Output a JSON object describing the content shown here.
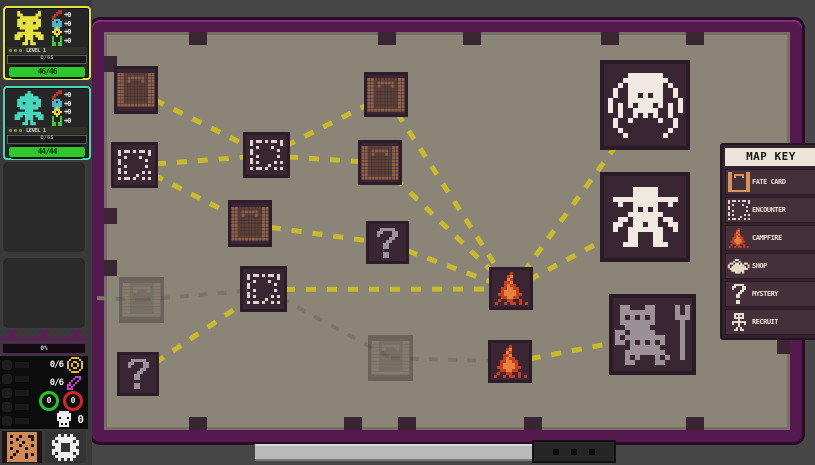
{
  "party": {
    "members": [
      {
        "portrait": "yellow-adventurer",
        "accent": "#e6e23e",
        "level_label": "LEVEL 1",
        "xp_label": "0/65",
        "hp_label": "46/46",
        "stats": [
          {
            "icon": "attack-icon",
            "value": "+0"
          },
          {
            "icon": "armor-icon",
            "value": "+0"
          },
          {
            "icon": "focus-icon",
            "value": "+0"
          },
          {
            "icon": "speed-icon",
            "value": "+0"
          }
        ]
      },
      {
        "portrait": "teal-adventurer",
        "accent": "#46d8be",
        "level_label": "LEVEL 1",
        "xp_label": "0/65",
        "hp_label": "44/44",
        "stats": [
          {
            "icon": "attack-icon",
            "value": "+0"
          },
          {
            "icon": "armor-icon",
            "value": "+0"
          },
          {
            "icon": "focus-icon",
            "value": "+0"
          },
          {
            "icon": "speed-icon",
            "value": "+0"
          }
        ]
      }
    ],
    "empty_slots": 2
  },
  "resources": {
    "progress_label": "0%",
    "counters": [
      {
        "icon": "coin-icon",
        "value": "0/6"
      },
      {
        "icon": "gem-icon",
        "value": "0/6"
      }
    ],
    "orbs": [
      {
        "icon": "green-orb",
        "value": "0"
      },
      {
        "icon": "red-orb",
        "value": "0"
      }
    ],
    "kills": {
      "icon": "skull-icon",
      "value": "0"
    }
  },
  "map_key": {
    "title": "MAP KEY",
    "entries": [
      {
        "icon": "fate-card-icon",
        "label": "FATE CARD"
      },
      {
        "icon": "encounter-icon",
        "label": "ENCOUNTER"
      },
      {
        "icon": "campfire-icon",
        "label": "CAMPFIRE"
      },
      {
        "icon": "shop-icon",
        "label": "SHOP"
      },
      {
        "icon": "mystery-icon",
        "label": "MYSTERY"
      },
      {
        "icon": "recruit-icon",
        "label": "RECRUIT"
      }
    ]
  },
  "map": {
    "nodes": [
      {
        "id": "n1",
        "type": "fate-card",
        "x": 114,
        "y": 66,
        "w": 44,
        "h": 48
      },
      {
        "id": "n2",
        "type": "encounter",
        "x": 111,
        "y": 142,
        "w": 47,
        "h": 46
      },
      {
        "id": "n3",
        "type": "encounter",
        "x": 243,
        "y": 132,
        "w": 47,
        "h": 46
      },
      {
        "id": "n4",
        "type": "fate-card",
        "x": 228,
        "y": 200,
        "w": 44,
        "h": 47
      },
      {
        "id": "n5",
        "type": "fate-card",
        "x": 364,
        "y": 72,
        "w": 44,
        "h": 45
      },
      {
        "id": "n6",
        "type": "fate-card",
        "x": 358,
        "y": 140,
        "w": 44,
        "h": 45
      },
      {
        "id": "n7",
        "type": "mystery",
        "x": 366,
        "y": 221,
        "w": 43,
        "h": 43
      },
      {
        "id": "n8",
        "type": "encounter",
        "x": 240,
        "y": 266,
        "w": 47,
        "h": 46
      },
      {
        "id": "n9",
        "type": "fate-card",
        "state": "visited",
        "x": 119,
        "y": 277,
        "w": 45,
        "h": 46
      },
      {
        "id": "n10",
        "type": "mystery",
        "x": 117,
        "y": 352,
        "w": 42,
        "h": 44
      },
      {
        "id": "n11",
        "type": "fate-card",
        "state": "visited",
        "x": 368,
        "y": 335,
        "w": 45,
        "h": 46
      },
      {
        "id": "n12",
        "type": "campfire",
        "x": 489,
        "y": 267,
        "w": 44,
        "h": 43
      },
      {
        "id": "n13",
        "type": "campfire",
        "x": 488,
        "y": 340,
        "w": 44,
        "h": 43
      },
      {
        "id": "n14",
        "type": "boss-spider",
        "x": 600,
        "y": 60,
        "w": 90,
        "h": 90
      },
      {
        "id": "n15",
        "type": "boss-cowboy",
        "x": 600,
        "y": 172,
        "w": 90,
        "h": 90
      },
      {
        "id": "n16",
        "type": "boss-golem",
        "x": 609,
        "y": 294,
        "w": 87,
        "h": 81
      }
    ],
    "anchor_points": {
      "wall-left": {
        "x": 97,
        "y": 298
      }
    },
    "connections": [
      {
        "a": "n1",
        "b": "n3",
        "style": "path"
      },
      {
        "a": "n2",
        "b": "n3",
        "style": "path"
      },
      {
        "a": "n2",
        "b": "n4",
        "style": "path"
      },
      {
        "a": "n3",
        "b": "n5",
        "style": "path"
      },
      {
        "a": "n3",
        "b": "n6",
        "style": "path"
      },
      {
        "a": "n4",
        "b": "n7",
        "style": "path"
      },
      {
        "a": "n5",
        "b": "n12",
        "style": "path"
      },
      {
        "a": "n6",
        "b": "n12",
        "style": "path"
      },
      {
        "a": "n7",
        "b": "n12",
        "style": "path"
      },
      {
        "a": "n8",
        "b": "n12",
        "style": "path"
      },
      {
        "a": "n10",
        "b": "n8",
        "style": "path"
      },
      {
        "a": "n12",
        "b": "n14",
        "style": "path"
      },
      {
        "a": "n12",
        "b": "n15",
        "style": "path"
      },
      {
        "a": "n13",
        "b": "n16",
        "style": "path"
      },
      {
        "a": "wall-left",
        "b": "n9",
        "style": "traveled"
      },
      {
        "a": "n9",
        "b": "n8",
        "style": "traveled"
      },
      {
        "a": "n8",
        "b": "n11",
        "style": "traveled"
      },
      {
        "a": "n11",
        "b": "n13",
        "style": "traveled"
      }
    ]
  },
  "colors": {
    "accent_yellow": "#e6e23e",
    "accent_teal": "#46d8be",
    "hp_green": "#2ec82e",
    "frame_purple": "#54194f",
    "path_yellow": "#c9ba2b",
    "path_traveled": "#7b7668",
    "map_surface": "#8b8577",
    "node_plum": "#3a2532"
  }
}
